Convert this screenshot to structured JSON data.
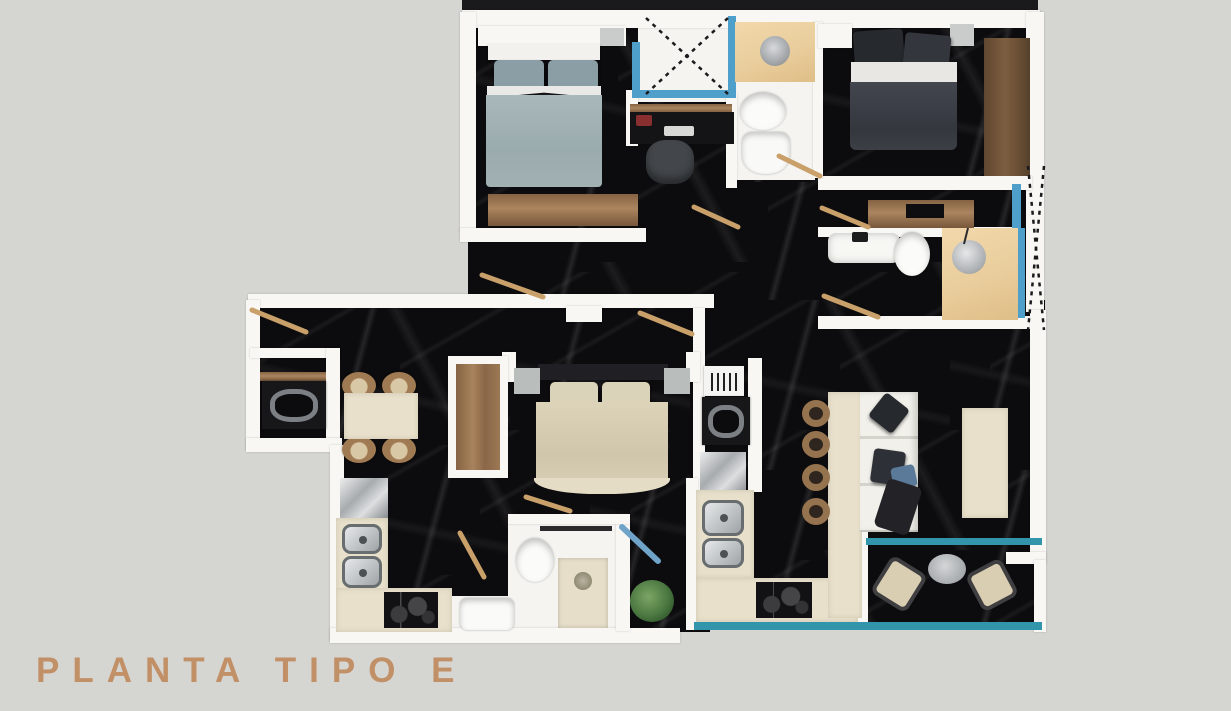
{
  "title": {
    "label": "PLANTA TIPO E"
  },
  "palette": {
    "background": "#d5d5d1",
    "title": "#c29067",
    "wall": "#f8f7f3",
    "marble": "#0c0c0e",
    "glass": "#4f9fcb",
    "railing": "#3295ab",
    "wood": "#9a7856",
    "wood_dark": "#6e5137",
    "wood_light": "#eed2a6",
    "counter": "#e8e0ca",
    "door_swing": "#c9a06a"
  },
  "plan": {
    "name": "planta-tipo-e-floor-plan",
    "floor_material": "black-marble",
    "rooms": [
      "bedroom-top-left",
      "bedroom-top-right",
      "bedroom-middle",
      "bathroom-top",
      "bathroom-right",
      "bathroom-bottom",
      "kitchen-left",
      "kitchen-right",
      "dining-area",
      "living-room",
      "laundry-closet",
      "balcony",
      "patio-lightwell",
      "corridor"
    ],
    "furniture": [
      "double-bed-gray",
      "double-bed-dark",
      "double-bed-beige",
      "desk-with-office-chair",
      "wardrobe",
      "dresser",
      "tv-console",
      "toilet",
      "pedestal-sink",
      "bathtub",
      "shower",
      "vanity-with-round-sink",
      "washing-machine",
      "dining-table-with-four-chairs",
      "refrigerator",
      "double-basin-sink",
      "cooktop",
      "oven",
      "kitchen-island-with-stools",
      "sofa-with-cushions",
      "coffee-table",
      "balcony-table-with-chairs",
      "plant",
      "glass-partitions",
      "door-swings"
    ]
  }
}
